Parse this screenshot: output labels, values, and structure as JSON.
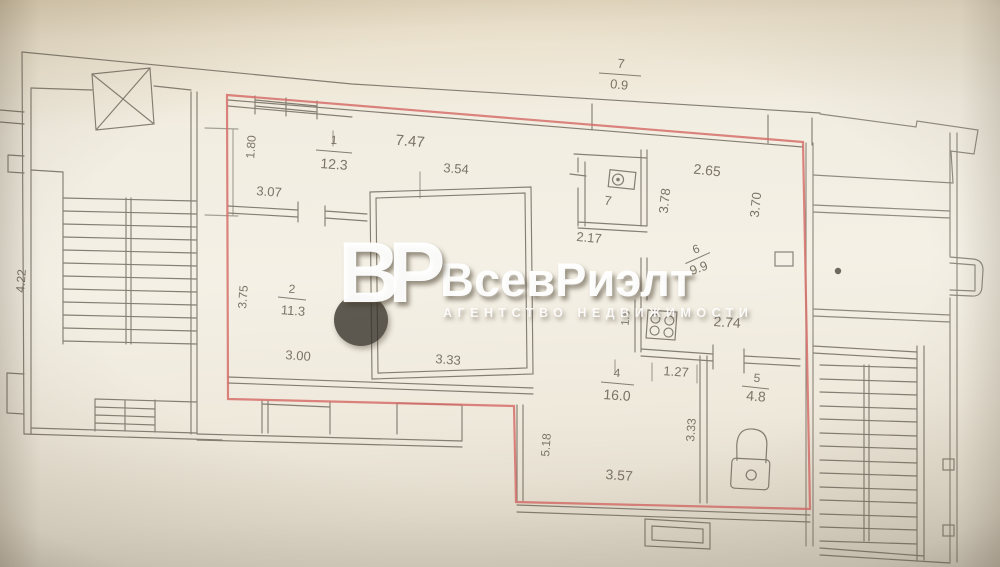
{
  "watermark": {
    "logo": "ВР",
    "title": "ВсевРиэлт",
    "subtitle": "АГЕНТСТВО НЕДВИЖИМОСТИ"
  },
  "rooms": {
    "r1": {
      "num": "1",
      "area": "12.3"
    },
    "r2": {
      "num": "2",
      "area": "11.3"
    },
    "r4": {
      "num": "4",
      "area": "16.0"
    },
    "r5": {
      "num": "5",
      "area": "4.8"
    },
    "r6": {
      "num": "6",
      "area": "9.9"
    },
    "r7wc": {
      "num": "7"
    },
    "balcony": {
      "num": "7",
      "area": "0.9"
    }
  },
  "dimensions": {
    "top_width": "7.47",
    "w354": "3.54",
    "w307": "3.07",
    "h180": "1.80",
    "w265": "2.65",
    "h378": "3.78",
    "h370": "3.70",
    "w217": "2.17",
    "w274": "2.74",
    "h16": "1.6",
    "h375": "3.75",
    "w300": "3.00",
    "w333": "3.33",
    "w127": "1.27",
    "h333": "3.33",
    "w357": "3.57",
    "h518": "5.18",
    "h422": "4.22"
  },
  "colors": {
    "apartment_outline": "#d66f6a",
    "wall_line": "#6a6358",
    "paper": "#f2ede1"
  }
}
